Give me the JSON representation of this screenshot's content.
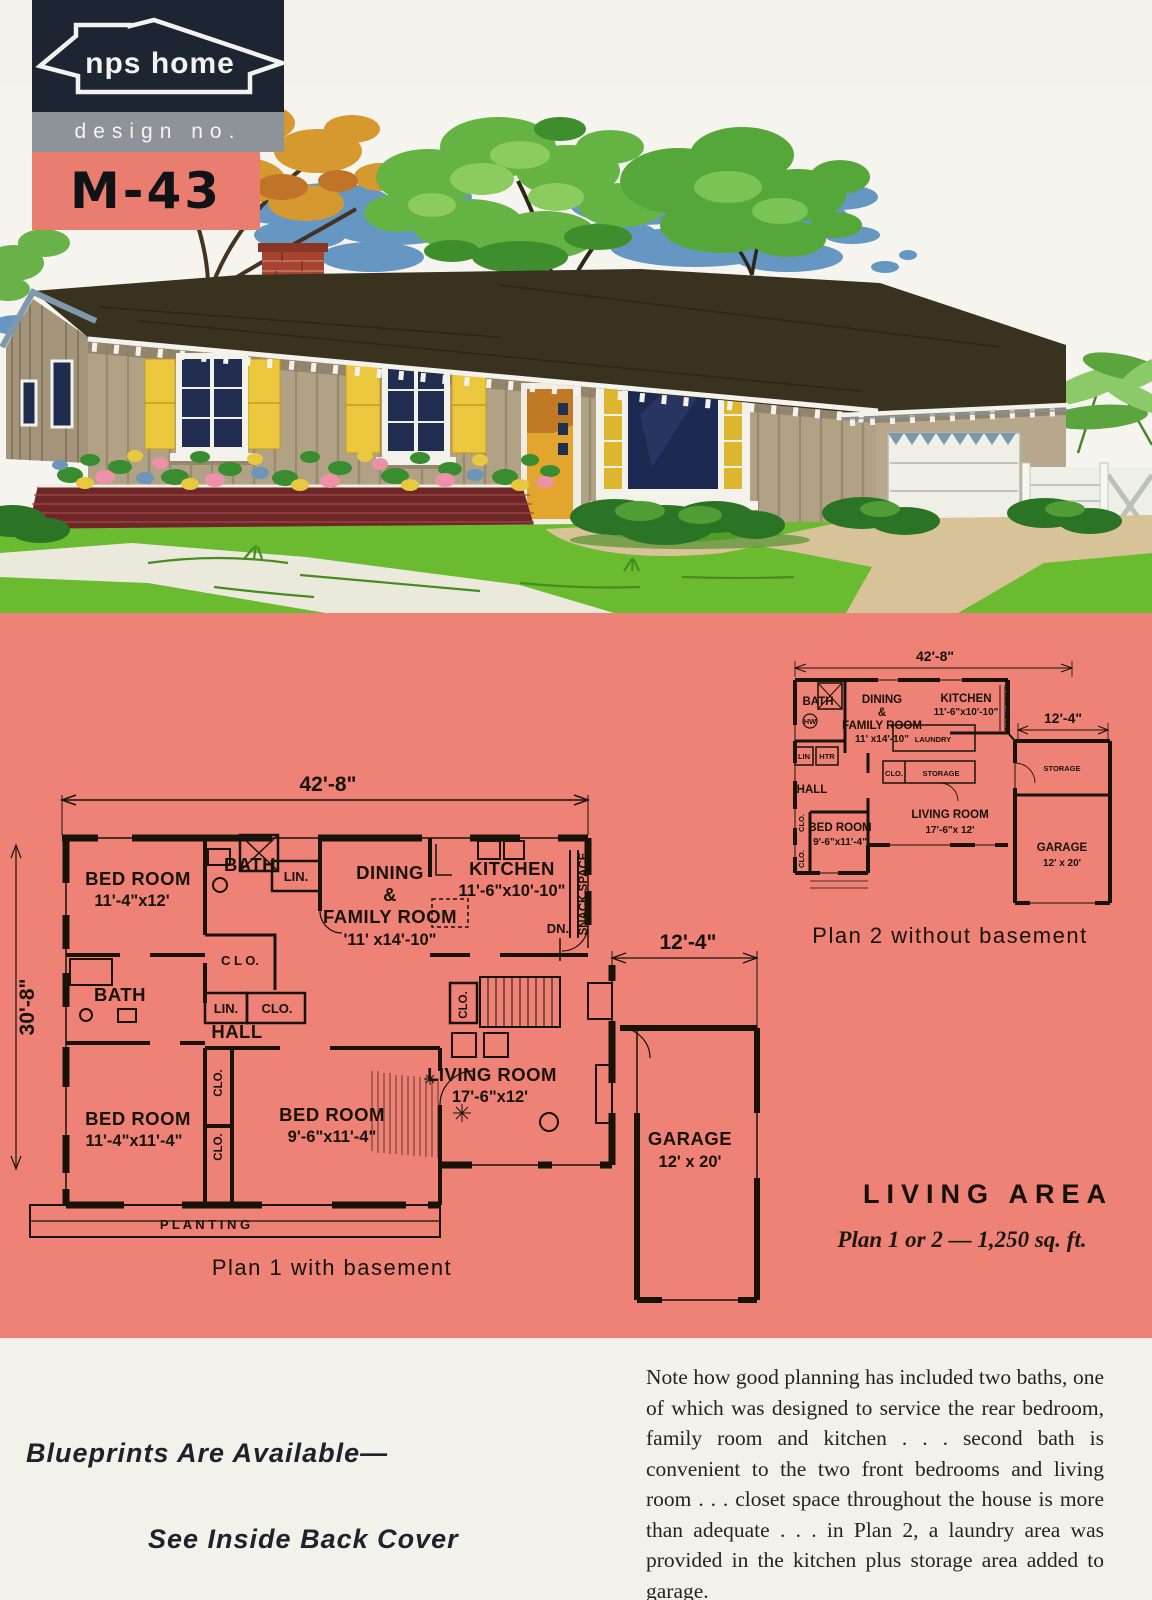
{
  "logo": {
    "brand": "nps home",
    "design_label": "design no.",
    "design_number": "M-43"
  },
  "living_area": {
    "title": "LIVING AREA",
    "subtitle": "Plan 1 or 2 — 1,250 sq. ft."
  },
  "plan1": {
    "caption": "Plan 1 with basement",
    "dim_top": "42'-8\"",
    "dim_left": "30'-8\"",
    "dim_garage": "12'-4\"",
    "bedroom1_name": "BED ROOM",
    "bedroom1_size": "11'-4\"x12'",
    "bath1": "BATH",
    "lin": "LIN.",
    "clo": "CLO.",
    "clo_spaced": "C L O.",
    "dining_l1": "DINING",
    "dining_l2": "&",
    "dining_l3": "FAMILY ROOM",
    "dining_size": "'11' x14'-10\"",
    "kitchen_name": "KITCHEN",
    "kitchen_size": "11'-6\"x10'-10\"",
    "snack": "SNACK SPACE",
    "dn": "DN.",
    "bath2": "BATH",
    "hall": "HALL",
    "bedroom2_name": "BED ROOM",
    "bedroom2_size": "11'-4\"x11'-4\"",
    "bedroom3_name": "BED ROOM",
    "bedroom3_size": "9'-6\"x11'-4\"",
    "living_name": "LIVING ROOM",
    "living_size": "17'-6\"x12'",
    "garage_name": "GARAGE",
    "garage_size": "12' x 20'",
    "planting": "P L A N T I N G"
  },
  "plan2": {
    "caption": "Plan 2 without basement",
    "dim_top": "42'-8\"",
    "dim_garage": "12'-4\"",
    "bath": "BATH",
    "dining_l1": "DINING",
    "dining_l2": "&",
    "dining_l3": "FAMILY ROOM",
    "dining_size": "11' x14'-10\"",
    "kitchen_name": "KITCHEN",
    "kitchen_size": "11'-6\"x10'-10\"",
    "snack": "SNACK SPACE",
    "laundry": "LAUNDRY",
    "clo": "CLO.",
    "storage1": "STORAGE",
    "storage2": "STORAGE",
    "lin": "LIN",
    "htr": "HTR",
    "hw": "HW",
    "hall": "HALL",
    "bedroom_name": "BED ROOM",
    "bedroom_size": "9'-6\"x11'-4\"",
    "living_name": "LIVING ROOM",
    "living_size": "17'-6\"x 12'",
    "garage_name": "GARAGE",
    "garage_size": "12' x 20'"
  },
  "note": "Note how good planning has included two baths, one of which was designed to service the rear bedroom, family room and kitchen . . . second bath is convenient to the two front bedrooms and living room . . . closet space throughout the house is more than adequate . . . in Plan 2, a laundry area was provided in the kitchen plus storage area added to garage.",
  "blueprints": {
    "line1": "Blueprints Are Available—",
    "line2": "See Inside Back Cover"
  },
  "colors": {
    "panel_pink": "#ee8277",
    "logo_navy": "#1c2531",
    "logo_gray": "#8d9398",
    "logo_salmon": "#e87d70",
    "page_bg": "#f3f2ea",
    "plan_ink": "#191209",
    "lawn_green": "#6bbb31",
    "cloud_blue": "#6697c2",
    "siding_tan": "#b1a286",
    "roof_dark": "#38321f",
    "shutter_yellow": "#eac73d",
    "brick_planter": "#6f2629",
    "window_navy": "#1c2950"
  }
}
